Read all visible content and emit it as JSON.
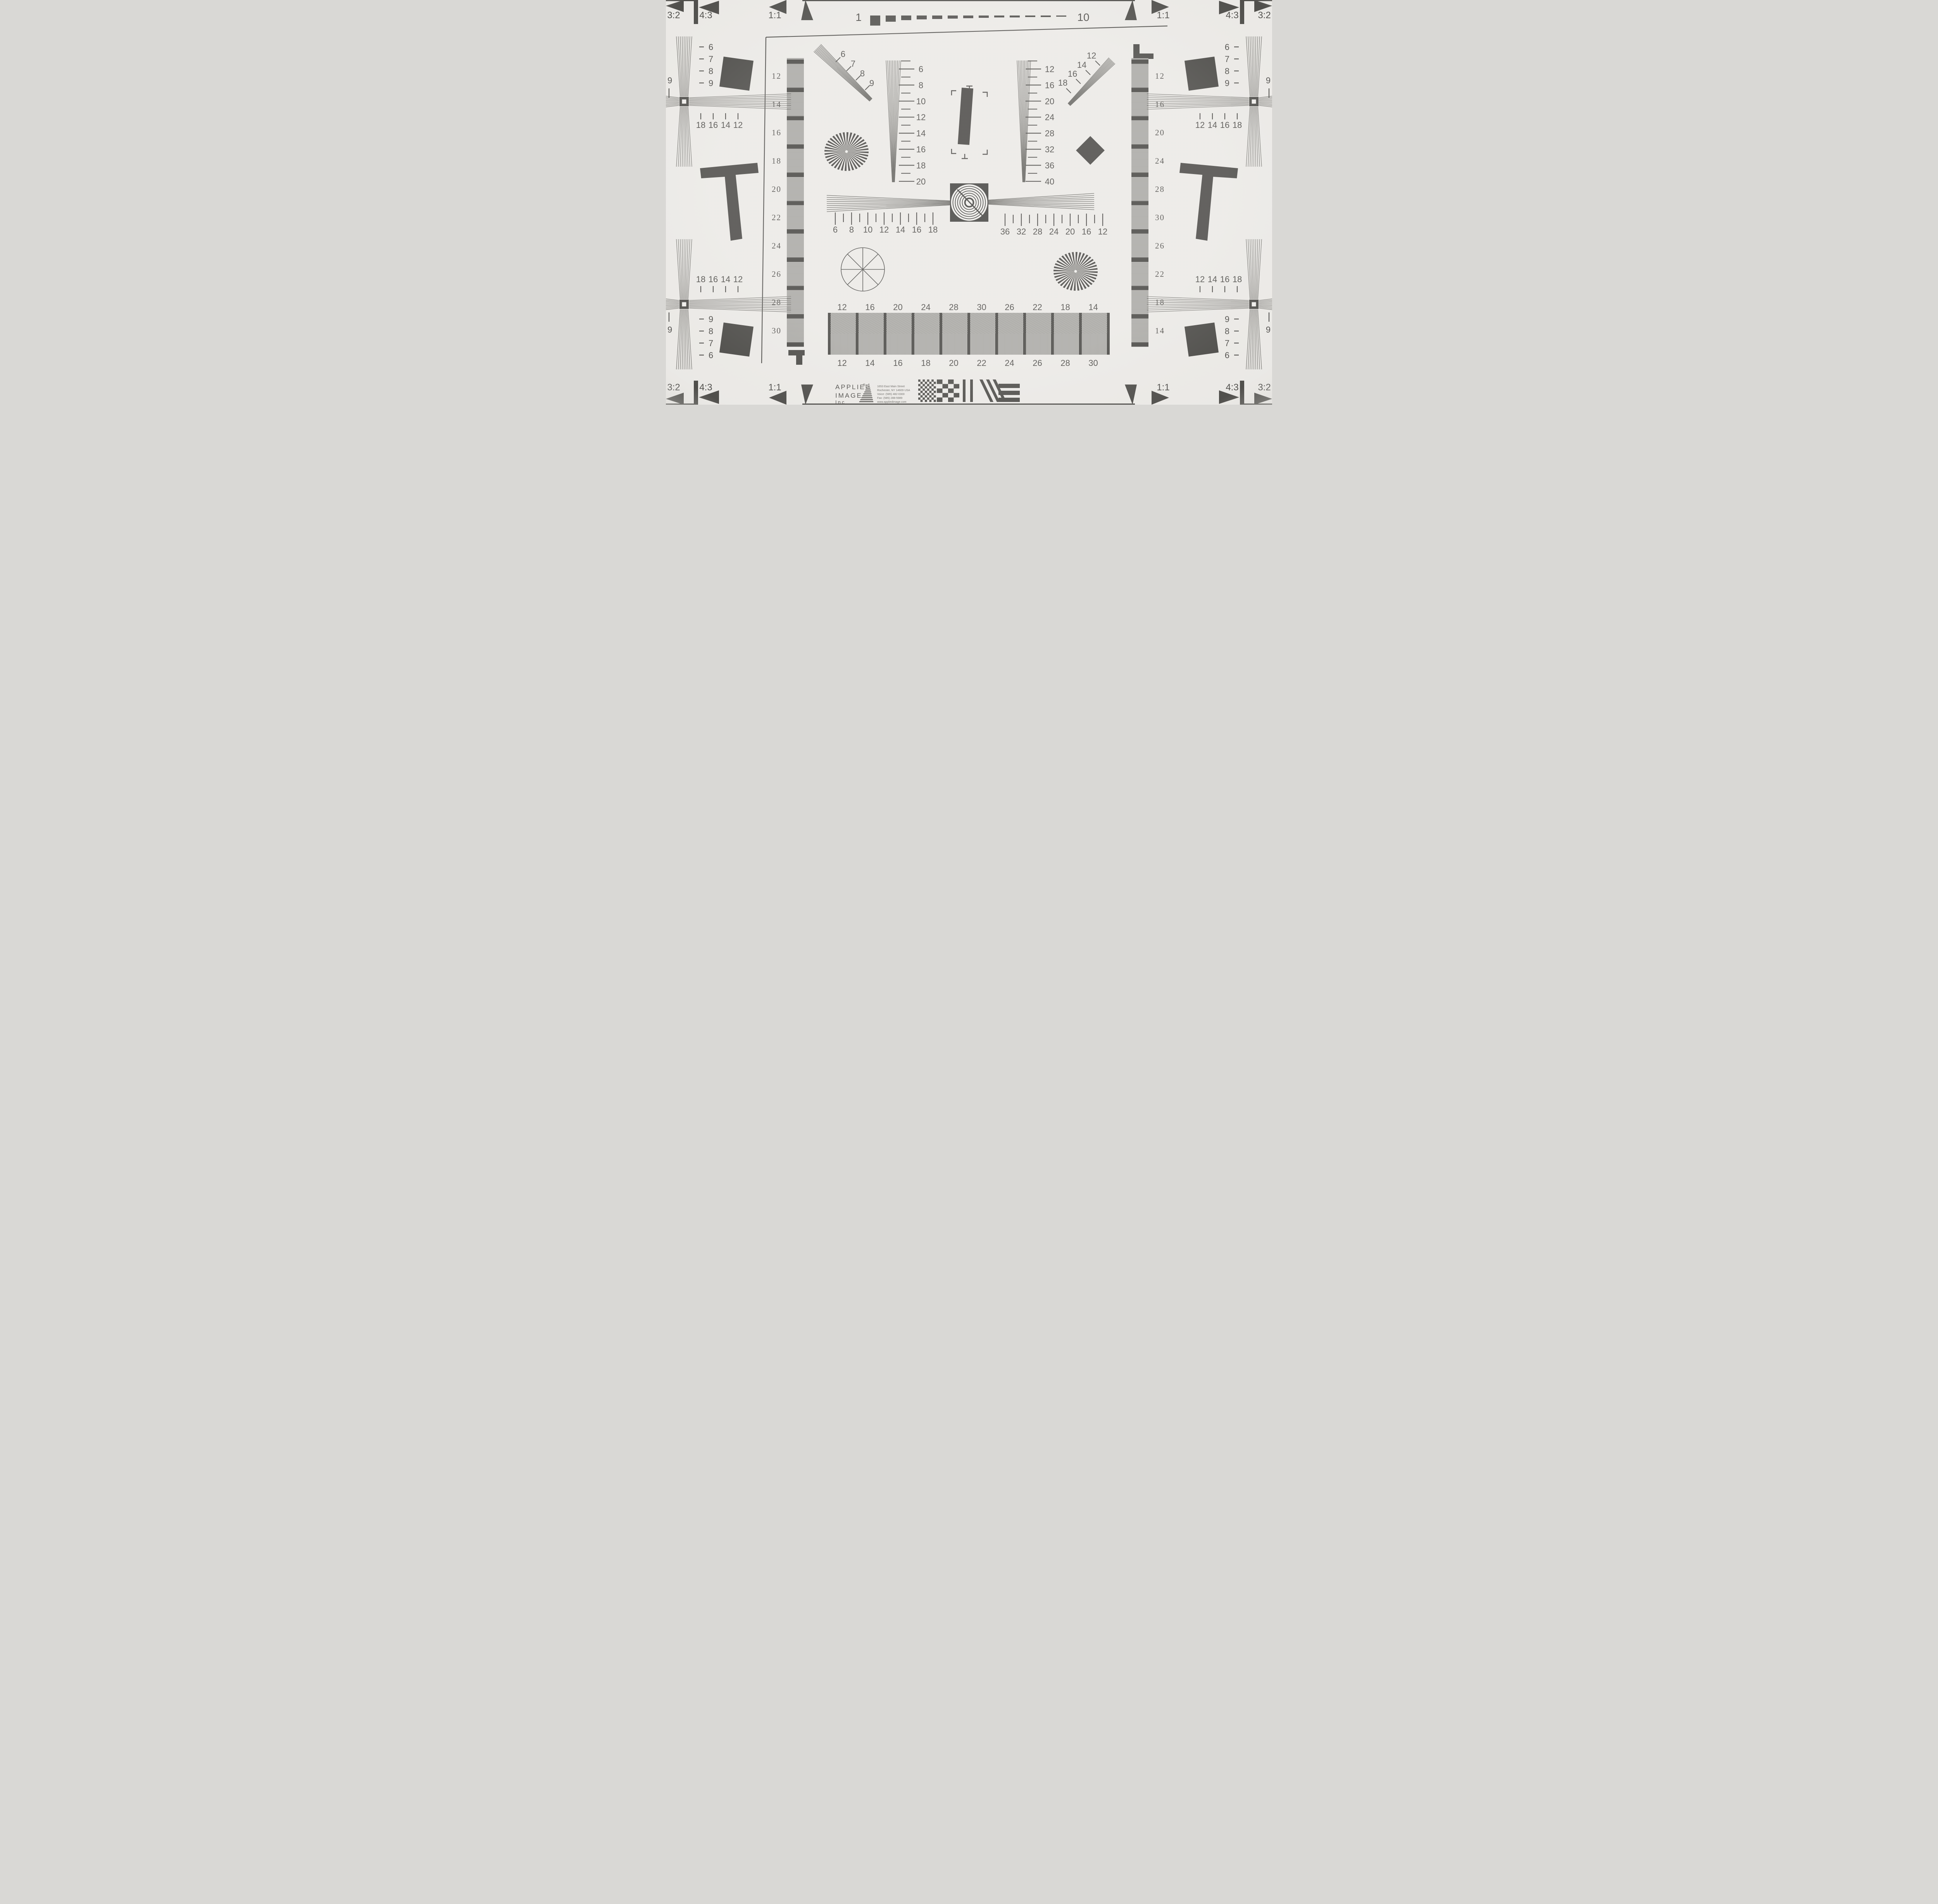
{
  "title": "ISO 12233 Resolution Test Chart",
  "colors": {
    "paper": "#eceae7",
    "ink": "#1e1d1a",
    "fan_line": "#3f3e3a",
    "grating_gray": "#b7b6b3"
  },
  "corners": {
    "top_left": [
      "3:2",
      "4:3",
      "1:1"
    ],
    "top_right": [
      "1:1",
      "4:3",
      "3:2"
    ],
    "bottom_left": [
      "3:2",
      "4:3",
      "1:1"
    ],
    "bottom_right": [
      "1:1",
      "4:3",
      "3:2"
    ]
  },
  "top_scale": {
    "left": "1",
    "right": "10"
  },
  "crosses": {
    "upper_left": {
      "wedge_labels": [
        "6",
        "7",
        "8",
        "9"
      ],
      "tick_labels": [
        "18",
        "16",
        "14",
        "12"
      ],
      "edge_label": "9"
    },
    "lower_left": {
      "wedge_labels": [
        "9",
        "8",
        "7",
        "6"
      ],
      "tick_labels": [
        "18",
        "16",
        "14",
        "12"
      ],
      "edge_label": "9"
    },
    "upper_right": {
      "wedge_labels": [
        "6",
        "7",
        "8",
        "9"
      ],
      "tick_labels": [
        "12",
        "14",
        "16",
        "18"
      ],
      "edge_label": "9"
    },
    "lower_right": {
      "wedge_labels": [
        "9",
        "8",
        "7",
        "6"
      ],
      "tick_labels": [
        "12",
        "14",
        "16",
        "18"
      ],
      "edge_label": "9"
    }
  },
  "gray_bars": {
    "left_labels": [
      "12",
      "14",
      "16",
      "18",
      "20",
      "22",
      "24",
      "26",
      "28",
      "30"
    ],
    "right_labels": [
      "12",
      "16",
      "20",
      "24",
      "28",
      "30",
      "26",
      "22",
      "18",
      "14"
    ]
  },
  "wedges": {
    "upper_left_diagonal": [
      "6",
      "7",
      "8",
      "9"
    ],
    "left_vertical": [
      "6",
      "8",
      "10",
      "12",
      "14",
      "16",
      "18",
      "20"
    ],
    "right_vertical": [
      "12",
      "16",
      "20",
      "24",
      "28",
      "32",
      "36",
      "40"
    ],
    "upper_right_diagonal": [
      "12",
      "14",
      "16",
      "18"
    ],
    "center_left": [
      "6",
      "8",
      "10",
      "12",
      "14",
      "16",
      "18"
    ],
    "center_right": [
      "36",
      "32",
      "28",
      "24",
      "20",
      "16",
      "12"
    ]
  },
  "bottom_bar": {
    "top_labels": [
      "12",
      "16",
      "20",
      "24",
      "28",
      "30",
      "26",
      "22",
      "18",
      "14"
    ],
    "bottom_labels": [
      "12",
      "14",
      "16",
      "18",
      "20",
      "22",
      "24",
      "26",
      "28",
      "30"
    ]
  },
  "logo": {
    "word1": "APPLIED",
    "reg": "®",
    "word2": "IMAGE",
    "word3": "Inc",
    "address": [
      "1653 East Main Street",
      "Rochester, NY  14609  USA",
      "Voice:   (585) 482-0300",
      "Fax:      (585) 288-5989",
      "www.appliedimage.com"
    ]
  }
}
